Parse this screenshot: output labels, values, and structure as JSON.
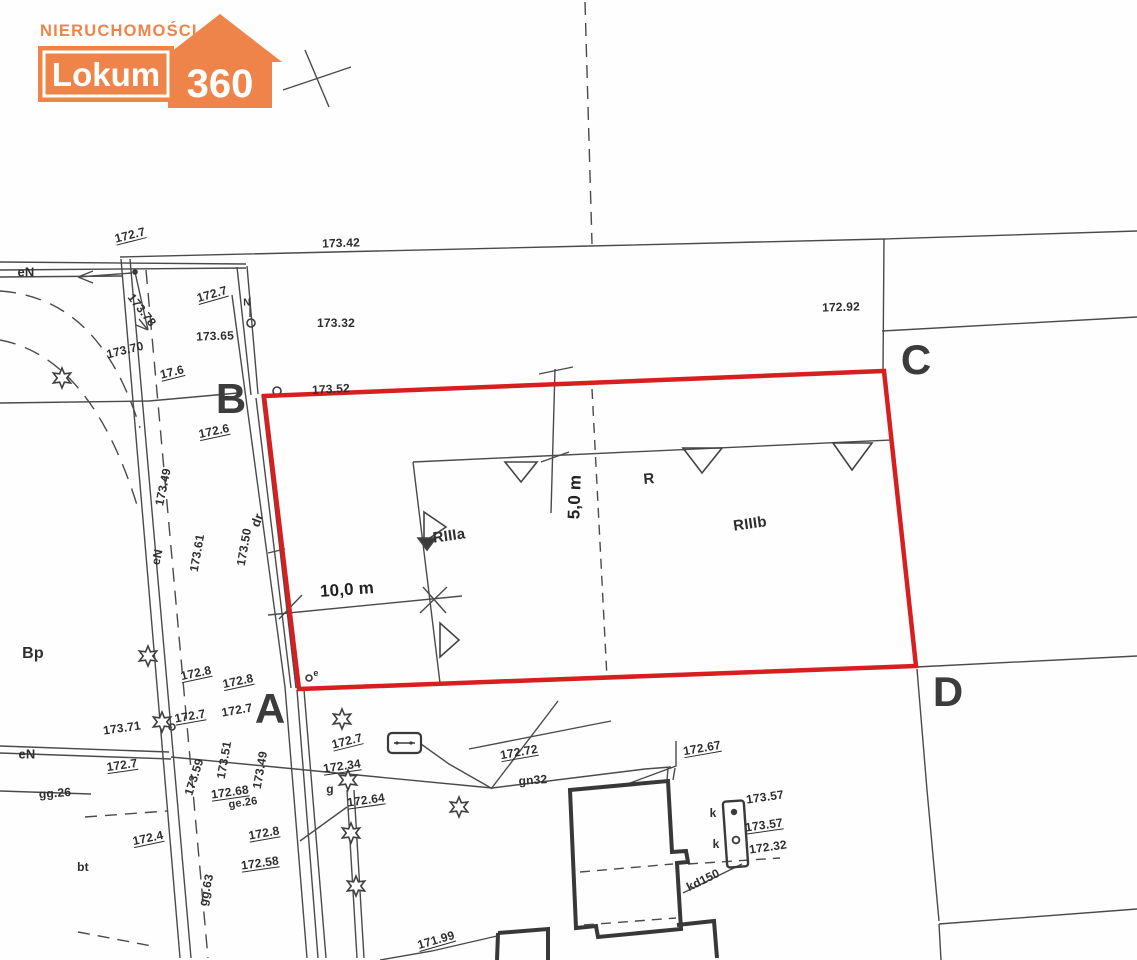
{
  "logo": {
    "top_text": "NIERUCHOMOŚCI",
    "name": "Lokum",
    "number": "360",
    "color": "#ee8449"
  },
  "map": {
    "red_boundary_color": "#d81f1f",
    "corners": [
      {
        "t": "B",
        "x": 231,
        "y": 399
      },
      {
        "t": "C",
        "x": 916,
        "y": 360
      },
      {
        "t": "D",
        "x": 948,
        "y": 692
      },
      {
        "t": "A",
        "x": 270,
        "y": 709
      }
    ],
    "labels": [
      {
        "t": "172.7",
        "x": 130,
        "y": 235,
        "r": -14,
        "u": 1
      },
      {
        "t": "173.42",
        "x": 341,
        "y": 243,
        "r": -2
      },
      {
        "t": "eN",
        "x": 26,
        "y": 272,
        "r": 0,
        "s": 13
      },
      {
        "t": "173.78",
        "x": 142,
        "y": 310,
        "r": 52
      },
      {
        "t": "172.7",
        "x": 212,
        "y": 294,
        "r": -16,
        "u": 1
      },
      {
        "t": "173.65",
        "x": 215,
        "y": 336,
        "r": -2
      },
      {
        "t": "173.70",
        "x": 125,
        "y": 350,
        "r": -14
      },
      {
        "t": "17.6",
        "x": 172,
        "y": 372,
        "r": -14,
        "u": 1
      },
      {
        "t": "173.32",
        "x": 336,
        "y": 323,
        "r": 0
      },
      {
        "t": "172.92",
        "x": 841,
        "y": 307,
        "r": -2
      },
      {
        "t": "173.52",
        "x": 331,
        "y": 389,
        "r": -3
      },
      {
        "t": "N",
        "x": 247,
        "y": 303,
        "r": 0,
        "s": 10
      },
      {
        "t": "172.6",
        "x": 214,
        "y": 431,
        "r": -12,
        "u": 1
      },
      {
        "t": "173.49",
        "x": 163,
        "y": 487,
        "r": -78
      },
      {
        "t": "eN",
        "x": 157,
        "y": 557,
        "r": -78
      },
      {
        "t": "173.61",
        "x": 197,
        "y": 553,
        "r": -80
      },
      {
        "t": "173.50",
        "x": 244,
        "y": 547,
        "r": -80
      },
      {
        "t": "dr",
        "x": 257,
        "y": 520,
        "r": -70,
        "s": 13
      },
      {
        "t": "10,0 m",
        "x": 347,
        "y": 590,
        "r": -4,
        "s": 17,
        "b": 1
      },
      {
        "t": "5,0 m",
        "x": 575,
        "y": 497,
        "r": -88,
        "s": 17,
        "b": 1
      },
      {
        "t": "RIIIa",
        "x": 449,
        "y": 536,
        "r": -8,
        "s": 15
      },
      {
        "t": "R",
        "x": 649,
        "y": 479,
        "r": -5,
        "s": 15
      },
      {
        "t": "RIIIb",
        "x": 750,
        "y": 524,
        "r": -8,
        "s": 15
      },
      {
        "t": "Bp",
        "x": 33,
        "y": 654,
        "r": 0,
        "s": 16
      },
      {
        "t": "172.8",
        "x": 196,
        "y": 673,
        "r": -12,
        "u": 1
      },
      {
        "t": "172.8",
        "x": 238,
        "y": 681,
        "r": -12,
        "u": 1
      },
      {
        "t": "173.71",
        "x": 122,
        "y": 728,
        "r": -8
      },
      {
        "t": "172.7",
        "x": 190,
        "y": 716,
        "r": -10,
        "u": 1
      },
      {
        "t": "172.7",
        "x": 237,
        "y": 710,
        "r": -10
      },
      {
        "t": "173.51",
        "x": 224,
        "y": 760,
        "r": -80
      },
      {
        "t": "173.59",
        "x": 194,
        "y": 777,
        "r": -72
      },
      {
        "t": "173.49",
        "x": 260,
        "y": 770,
        "r": -80
      },
      {
        "t": "172.68",
        "x": 230,
        "y": 792,
        "r": -8,
        "u": 1
      },
      {
        "t": "ge.26",
        "x": 243,
        "y": 803,
        "r": -8,
        "s": 11
      },
      {
        "t": "eN",
        "x": 27,
        "y": 754,
        "r": 0,
        "s": 13
      },
      {
        "t": "172.7",
        "x": 122,
        "y": 765,
        "r": -8,
        "u": 1
      },
      {
        "t": "gg.26",
        "x": 55,
        "y": 793,
        "r": -4
      },
      {
        "t": "172.4",
        "x": 148,
        "y": 838,
        "r": -12,
        "u": 1
      },
      {
        "t": "172.8",
        "x": 264,
        "y": 833,
        "r": -10,
        "u": 1
      },
      {
        "t": "172.58",
        "x": 260,
        "y": 863,
        "r": -8,
        "u": 1
      },
      {
        "t": "bt",
        "x": 83,
        "y": 867,
        "r": 0,
        "s": 12
      },
      {
        "t": "gg.63",
        "x": 206,
        "y": 890,
        "r": -78
      },
      {
        "t": "172.7",
        "x": 347,
        "y": 741,
        "r": -14,
        "u": 1
      },
      {
        "t": "172.34",
        "x": 342,
        "y": 766,
        "r": -8,
        "u": 1
      },
      {
        "t": "172.64",
        "x": 366,
        "y": 800,
        "r": -8,
        "u": 1
      },
      {
        "t": "172.72",
        "x": 519,
        "y": 752,
        "r": -10,
        "u": 1
      },
      {
        "t": "gn32",
        "x": 533,
        "y": 780,
        "r": -4
      },
      {
        "t": "g",
        "x": 330,
        "y": 789,
        "r": 0
      },
      {
        "t": "172.67",
        "x": 702,
        "y": 748,
        "r": -10,
        "u": 1
      },
      {
        "t": "k",
        "x": 713,
        "y": 813,
        "r": 0
      },
      {
        "t": "k",
        "x": 716,
        "y": 844,
        "r": 0
      },
      {
        "t": "173.57",
        "x": 765,
        "y": 797,
        "r": -8
      },
      {
        "t": "173.57",
        "x": 764,
        "y": 825,
        "r": -8,
        "u": 1
      },
      {
        "t": "172.32",
        "x": 768,
        "y": 847,
        "r": -8
      },
      {
        "t": "kd150",
        "x": 703,
        "y": 880,
        "r": -26
      },
      {
        "t": "171.99",
        "x": 436,
        "y": 940,
        "r": -16,
        "u": 1
      },
      {
        "t": "e",
        "x": 316,
        "y": 673,
        "r": 0,
        "s": 9
      }
    ]
  }
}
